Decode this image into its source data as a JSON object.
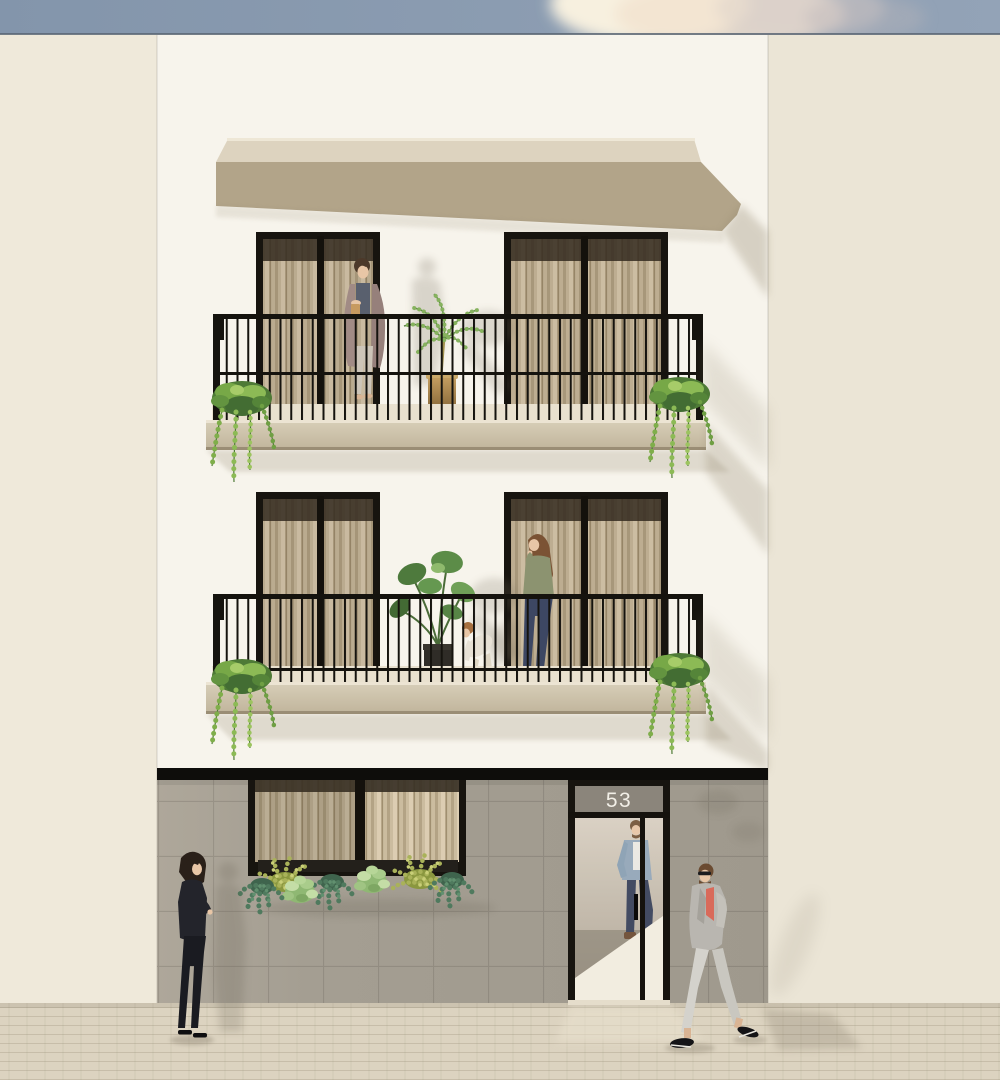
{
  "door": {
    "number": "53",
    "number_color": "#f2efe7"
  },
  "palette": {
    "sky": "#8a9ab0",
    "sky_edge_line": "#5c6776",
    "cloud": "#f9efdc",
    "neighbor_left_wall": "#efe9da",
    "neighbor_right_wall": "#ebe5d6",
    "facade_white": "#f7f4ec",
    "cornice_top": "#ddd3bf",
    "cornice_underside": "#b2a489",
    "window_frame": "#17140f",
    "curtain_base": "#cbbc9f",
    "railing_black": "#15130e",
    "balcony_slab": "#cfc5ae",
    "storefront_band": "#0e0d0b",
    "storefront_wall": "#a49e92",
    "transom_glass": "#8b857b",
    "door_glass": "#cdc4b5",
    "interior_light": "#f2ecdf",
    "pavement": "#dcd3c0",
    "ivy_green": "#7fae4a",
    "palm_green": "#6f9b4f",
    "monstera_green": "#4e7a3d",
    "pot_gold": "#b08d52",
    "planter_pot_dark": "#2f2c27",
    "shadow_tone": "#8d8168",
    "skin_tone": "#e8c6a6"
  },
  "people": [
    {
      "id": "woman-upper-balcony",
      "description": "woman with coffee cup, long taupe cardigan, grey top, cream trousers, upper balcony"
    },
    {
      "id": "woman-middle-balcony",
      "description": "woman in sage green blouse and navy jeans, middle balcony"
    },
    {
      "id": "child-middle-balcony",
      "description": "small child in light clothes bending beside plant, middle balcony"
    },
    {
      "id": "man-in-doorway",
      "description": "man in denim jacket and white tee standing inside the glass entrance"
    },
    {
      "id": "man-walking",
      "description": "bearded man with sunglasses, grey blazer, coral shirt, light trousers walking on sidewalk"
    },
    {
      "id": "woman-on-sidewalk",
      "description": "woman in black top and black jeans standing on sidewalk at left"
    }
  ],
  "plants": [
    {
      "id": "palm-plant",
      "location": "upper balcony, gold pot"
    },
    {
      "id": "monstera-plant",
      "location": "middle balcony, dark pot"
    },
    {
      "id": "ivy-upper-left"
    },
    {
      "id": "ivy-upper-right"
    },
    {
      "id": "ivy-middle-left"
    },
    {
      "id": "ivy-middle-right"
    },
    {
      "id": "window-planter",
      "location": "below ground floor window"
    }
  ]
}
